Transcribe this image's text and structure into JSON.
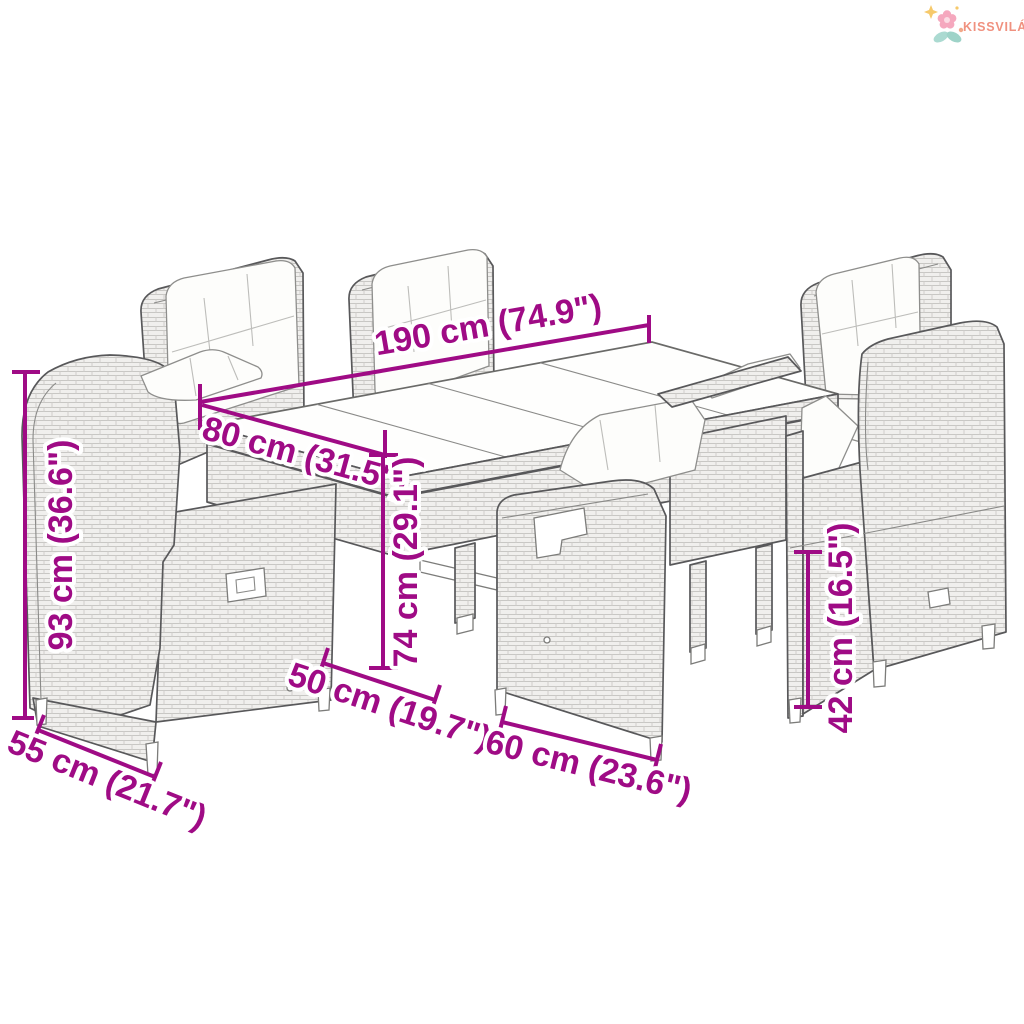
{
  "brand": {
    "name": "KISSVILÁG",
    "icon": "flower-logo-icon",
    "text_color": "#F0917F",
    "petal_pink": "#F5A8BE",
    "petal_core": "#FCDCE4",
    "leaf_teal": "#A4D6CB",
    "sparkle_yellow": "#F6C96B",
    "sparkle_orange": "#F2A98A"
  },
  "annotation_style": {
    "color": "#9F0B85",
    "halo": "#FFFFFF"
  },
  "illustration": {
    "subject": "garden dining set line drawing: glass-top poly rattan table with six reclining wicker chairs with white cushions",
    "outline_color": "#58585A",
    "wicker_fill": "#F0EFED",
    "cushion_color": "#FDFDFB"
  },
  "dimensions": {
    "table_length": {
      "label": "190 cm (74.9\")"
    },
    "table_width": {
      "label": "80 cm (31.5\")"
    },
    "table_height": {
      "label": "74 cm (29.1\")"
    },
    "chair_back_height": {
      "label": "93 cm (36.6\")"
    },
    "chair_width": {
      "label": "55 cm (21.7\")"
    },
    "seat_depth": {
      "label": "50 cm (19.7\")"
    },
    "chair_front_width": {
      "label": "60 cm (23.6\")"
    },
    "seat_height": {
      "label": "42 cm (16.5\")"
    }
  }
}
